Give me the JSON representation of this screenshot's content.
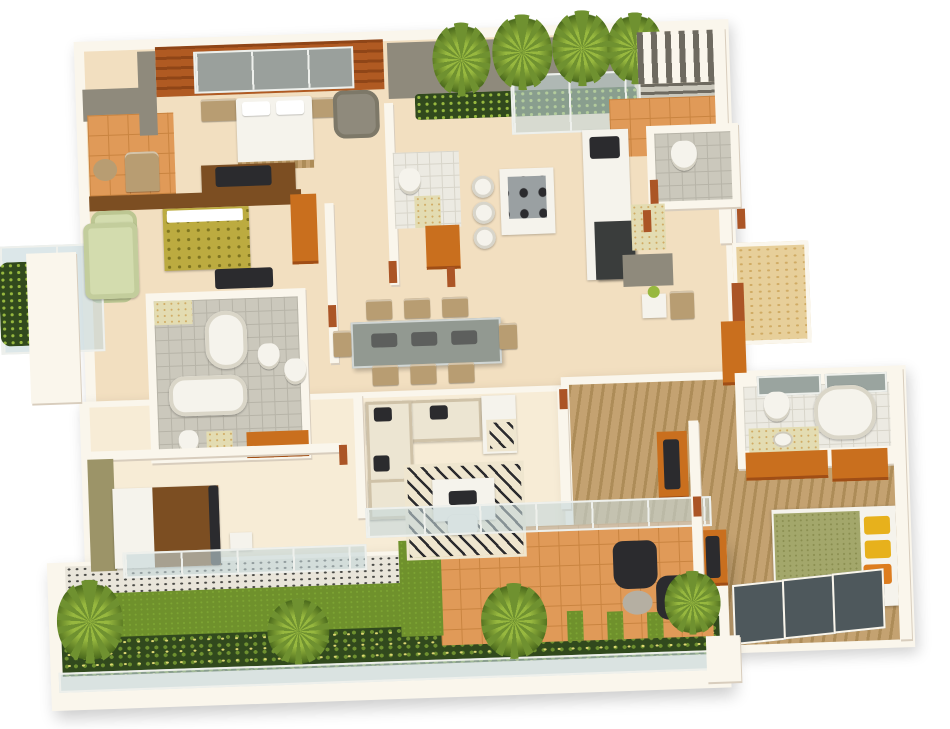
{
  "scene": {
    "type": "3d-floor-plan-render",
    "title": "4-bedroom house 3D floor plan, isometric top view",
    "background": "#ffffff",
    "rooms": [
      {
        "name": "master-bedroom",
        "features": [
          "wood-panel wall",
          "glass wardrobe",
          "double bed",
          "gray armchair",
          "tv-desk",
          "benches"
        ]
      },
      {
        "name": "terrace-top-left",
        "features": [
          "orange tile floor",
          "gray wall",
          "lounge chair",
          "round table"
        ]
      },
      {
        "name": "courtyard",
        "features": [
          "gray wall",
          "palm trees",
          "planter shrubs",
          "glass partition"
        ]
      },
      {
        "name": "slatted-screen-corner",
        "features": [
          "vertical slats",
          "orange tile"
        ]
      },
      {
        "name": "bedroom-2",
        "features": [
          "yellow patterned bed",
          "green armchairs",
          "tv",
          "orange wardrobe"
        ]
      },
      {
        "name": "balcony-left",
        "features": [
          "glass railing",
          "plants",
          "cream sofa"
        ]
      },
      {
        "name": "master-bathroom",
        "features": [
          "oval tub",
          "rect tub",
          "toilets",
          "marble vanity",
          "gray tile"
        ]
      },
      {
        "name": "kitchen",
        "features": [
          "island with cooktop",
          "bar stools",
          "long white counter",
          "dark sink",
          "dark fridge"
        ]
      },
      {
        "name": "powder-room",
        "features": [
          "toilet",
          "white tile"
        ]
      },
      {
        "name": "dining-room",
        "features": [
          "smoked glass table",
          "8 tan chairs"
        ]
      },
      {
        "name": "living-room",
        "features": [
          "L sectional sofa",
          "zebra rug",
          "coffee table",
          "orange tv cabinet",
          "glass wall"
        ]
      },
      {
        "name": "bedroom-3",
        "features": [
          "bed white+brown",
          "olive wall",
          "glass wall"
        ]
      },
      {
        "name": "entrance",
        "features": [
          "gold textured floor",
          "orange door",
          "orange sideboard"
        ]
      },
      {
        "name": "bedroom-4",
        "features": [
          "wood plank floor",
          "olive bed",
          "yellow pillows",
          "orange tv cabinets",
          "dark glass panels"
        ]
      },
      {
        "name": "ensuite-bathroom",
        "features": [
          "oval tub",
          "toilet",
          "marble counter",
          "orange vanity"
        ]
      },
      {
        "name": "patio",
        "features": [
          "orange tiles",
          "two dark armchairs",
          "stone table",
          "grass strips"
        ]
      },
      {
        "name": "garden",
        "features": [
          "pebble strip",
          "lawn",
          "flowering hedge",
          "glass fence",
          "palm bushes"
        ]
      }
    ]
  },
  "palette": {
    "page_bg": "#ffffff",
    "wall_white": "#faf6ec",
    "wall_edge": "#d8cdbd",
    "floor_cream": "#f2dfc0",
    "floor_cream_light": "#f7ecd6",
    "tile_orange": "#e09a58",
    "tile_grout": "#c98440",
    "gold_floor": "#e7cf9a",
    "gold_speckle": "#d0ab64",
    "wood_wall": "#b05a22",
    "wood_wall_dark": "#8f4517",
    "wood_floor": "#c4a271",
    "wood_floor_dark": "#ad8c58",
    "gray_wall": "#8f8a7c",
    "gray_tile": "#cbc8bc",
    "gray_grout": "#b7b4a8",
    "white_tile": "#eceae2",
    "white_grout": "#d8d5ca",
    "glass": "rgba(196,215,219,0.6)",
    "glass_frame": "#eef0ec",
    "glass_dark": "#4e585c",
    "grass": "#6f912c",
    "grass_light": "#7da433",
    "hedge": "#31491d",
    "flower": "#ded873",
    "pebble": "#e9e5da",
    "pebble_dot": "#4a4a46",
    "palm": "#6f9130",
    "palm_light": "#97b83f",
    "palm_dark": "#4c6b1d",
    "sofa_cream": "#ece5d2",
    "sofa_tan": "#cfc2a8",
    "charcoal": "#2b2b2e",
    "bed_white": "#f5f3ec",
    "bed_yellow": "#bcab40",
    "bed_yellow_dot": "#7e7420",
    "bed_olive": "#a3a76b",
    "bed_olive_dot": "#8a8e50",
    "blanket_brown": "#7c4e22",
    "pillow_yellow": "#e7b11c",
    "pillow_orange": "#dd7d1f",
    "orange_cab": "#c96f1e",
    "orange_cab_dark": "#a04e16",
    "marble": "#e3dcb2",
    "chair_tan": "#b89d72",
    "table_glass": "#8a948e",
    "olive_wall": "#9c9468",
    "stone": "#b5afa2",
    "slat_dark": "#6e6a60",
    "rug_cream": "#efe6cf",
    "accent_jamb": "#ab5526",
    "green_chair": "#d3dcae"
  }
}
